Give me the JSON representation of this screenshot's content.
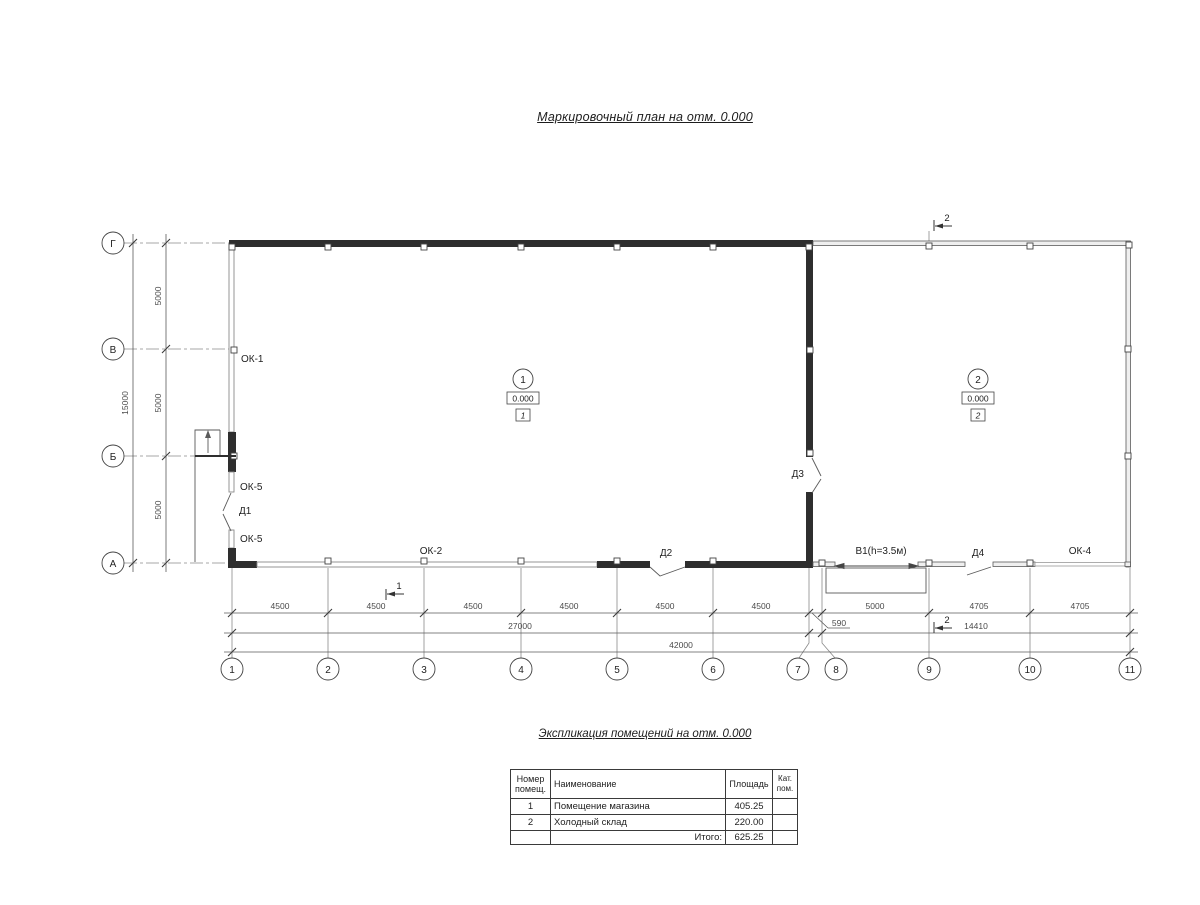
{
  "title": "Маркировочный план  на отм. 0.000",
  "plan": {
    "row_axes": [
      "Г",
      "В",
      "Б",
      "А"
    ],
    "col_axes": [
      "1",
      "2",
      "3",
      "4",
      "5",
      "6",
      "7",
      "8",
      "9",
      "10",
      "11"
    ],
    "dims": {
      "v_seg": [
        "5000",
        "5000",
        "5000"
      ],
      "v_total": "15000",
      "h_seg": [
        "4500",
        "4500",
        "4500",
        "4500",
        "4500",
        "4500"
      ],
      "h_590": "590",
      "h_5000": "5000",
      "h_4705a": "4705",
      "h_4705b": "4705",
      "h_27000": "27000",
      "h_14410": "14410",
      "h_42000": "42000"
    },
    "labels": {
      "ok1": "ОК-1",
      "ok5a": "ОК-5",
      "d1": "Д1",
      "ok5b": "ОК-5",
      "ok2": "ОК-2",
      "d2": "Д2",
      "d3": "Д3",
      "v1": "В1(h=3.5м)",
      "d4": "Д4",
      "ok4": "ОК-4"
    },
    "rooms": [
      {
        "num": "1",
        "elev": "0.000",
        "tag": "1"
      },
      {
        "num": "2",
        "elev": "0.000",
        "tag": "2"
      }
    ],
    "sections": {
      "s1": "1",
      "s2": "2"
    },
    "colors": {
      "wall": "#2e2e2e",
      "thin": "#5a5a5a",
      "dim": "#4a4a4a"
    }
  },
  "explication": {
    "title": "Экспликация помещений на отм. 0.000",
    "headers": {
      "num1": "Номер",
      "num2": "помещ.",
      "name": "Наименование",
      "area": "Площадь",
      "cat1": "Кат.",
      "cat2": "пом."
    },
    "rows": [
      {
        "num": "1",
        "name": "Помещение магазина",
        "area": "405.25",
        "cat": ""
      },
      {
        "num": "2",
        "name": "Холодный склад",
        "area": "220.00",
        "cat": ""
      }
    ],
    "total_label": "Итого:",
    "total": "625.25"
  }
}
